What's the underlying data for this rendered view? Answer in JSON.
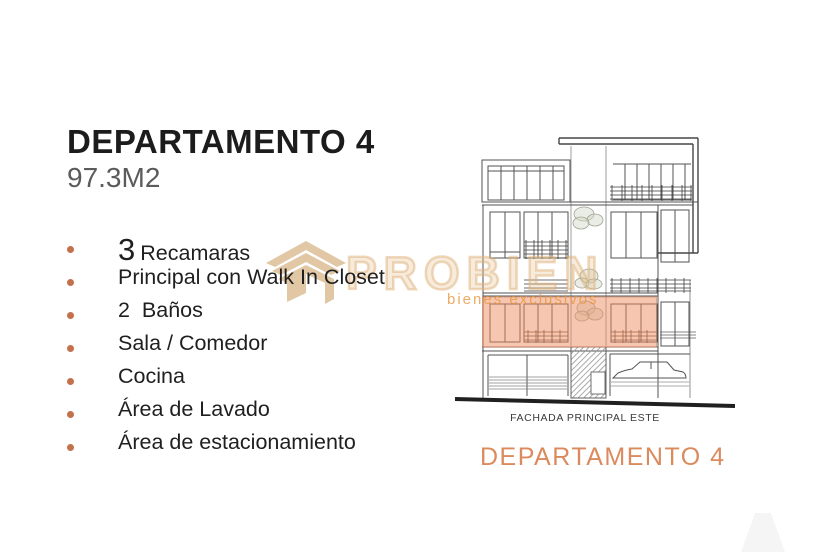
{
  "header": {
    "title": "DEPARTAMENTO 4",
    "area": "97.3M2"
  },
  "features": {
    "bullet_color": "#c3704b",
    "items": [
      {
        "number": "3",
        "label": "Recamaras"
      },
      {
        "number": "",
        "label": "Principal con Walk In Closet"
      },
      {
        "number": "",
        "label": "2  Baños"
      },
      {
        "number": "",
        "label": "Sala / Comedor"
      },
      {
        "number": "",
        "label": "Cocina"
      },
      {
        "number": "",
        "label": "Área de Lavado"
      },
      {
        "number": "",
        "label": "Área de estacionamiento"
      }
    ]
  },
  "watermark": {
    "brand": "PROBIEN",
    "tagline": "bienes exclusivos",
    "logo_color": "#dcbe95"
  },
  "elevation": {
    "caption": "FACHADA PRINCIPAL ESTE",
    "highlight_color": "#ee8557",
    "label": "DEPARTAMENTO 4",
    "label_color": "#db8a5d"
  }
}
